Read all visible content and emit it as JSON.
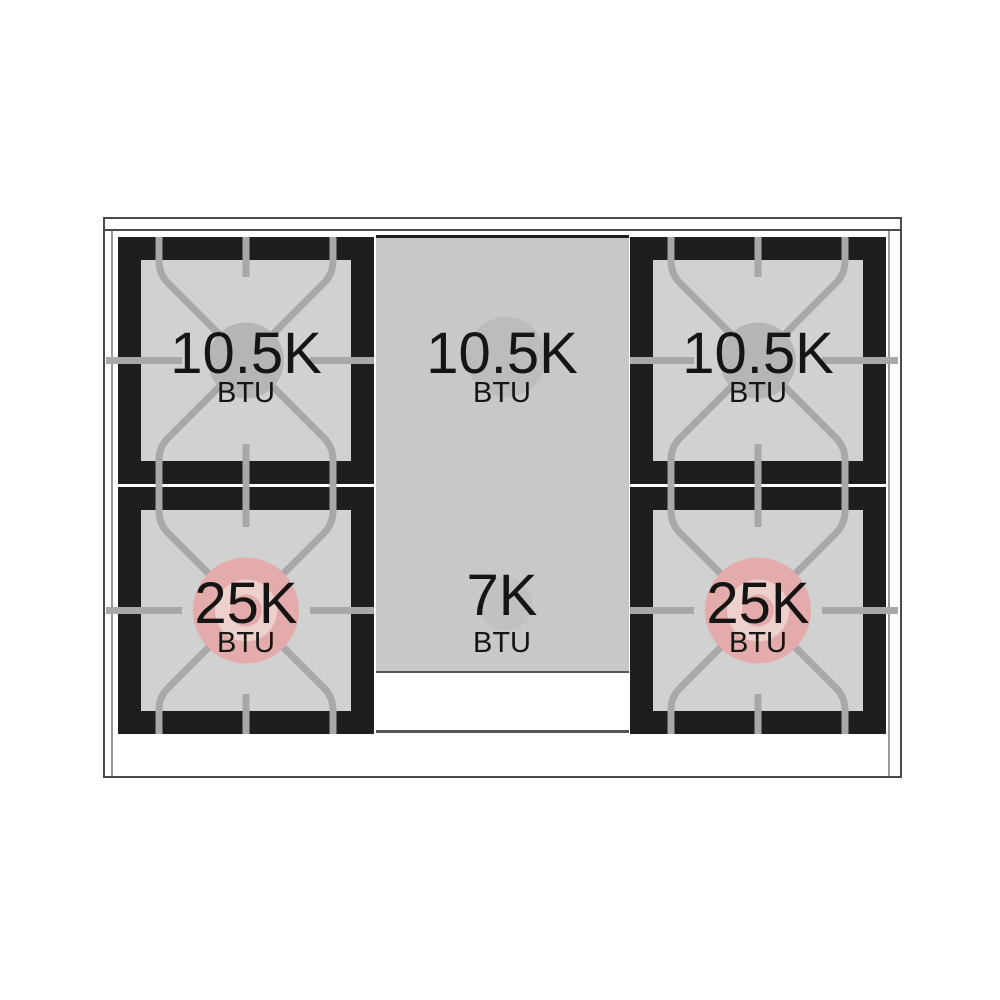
{
  "diagram": {
    "type": "gas-range-cooktop-top-view",
    "burners": {
      "top_left": {
        "value": "10.5K",
        "unit": "BTU"
      },
      "top_center": {
        "value": "10.5K",
        "unit": "BTU"
      },
      "top_right": {
        "value": "10.5K",
        "unit": "BTU"
      },
      "bottom_left": {
        "value": "25K",
        "unit": "BTU"
      },
      "bottom_center": {
        "value": "7K",
        "unit": "BTU"
      },
      "bottom_right": {
        "value": "25K",
        "unit": "BTU"
      }
    },
    "colors": {
      "frame_black": "#1e1e1e",
      "grate_gray": "#a8a8a8",
      "surface_gray": "#d1d1d1",
      "panel_gray": "#c8c8c8",
      "burner_cap_gray": "#b5b5b5",
      "panel_burner_gray": "#bcbcbc",
      "panel_burner_small_gray": "#c1c1c1",
      "burner_pink": "#e3acaa",
      "burner_pink_light": "#eed0cc",
      "outline_gray": "#4a4a4a",
      "trim_line_gray": "#9a9a9a",
      "drawer_line_gray": "#555555",
      "text_black": "#151515"
    }
  }
}
